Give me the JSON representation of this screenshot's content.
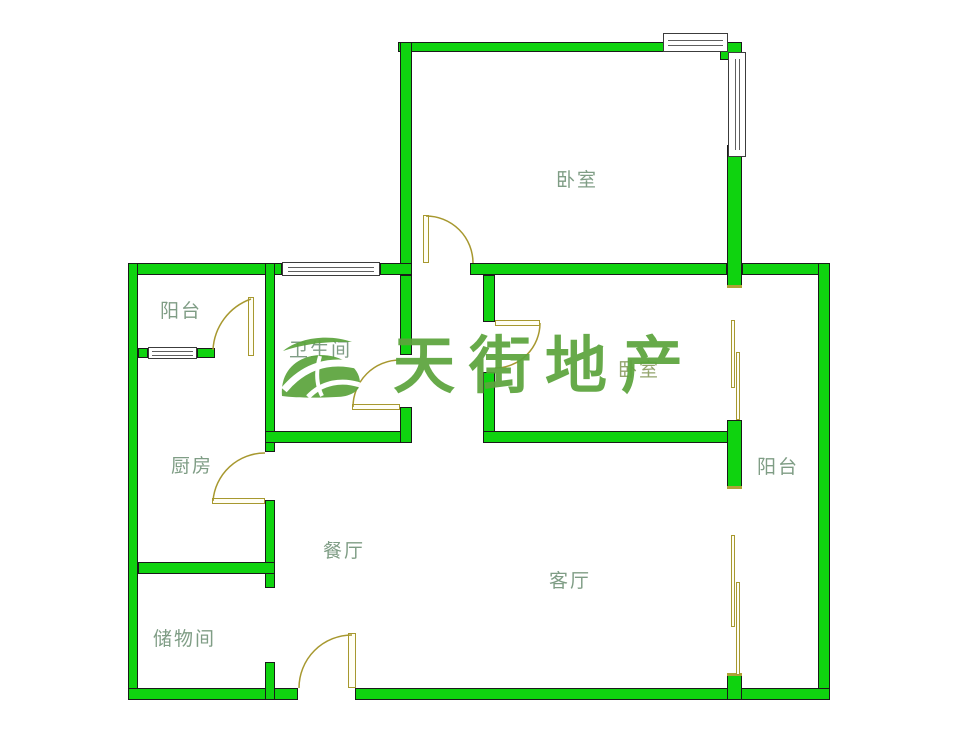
{
  "watermark": {
    "brand": "天街地产"
  },
  "rooms": {
    "bedroom_top": {
      "label": "卧室"
    },
    "balcony_top_left": {
      "label": "阳台"
    },
    "bathroom": {
      "label": "卫生间"
    },
    "bedroom_right": {
      "label": "卧室"
    },
    "balcony_right": {
      "label": "阳台"
    },
    "kitchen": {
      "label": "厨房"
    },
    "dining": {
      "label": "餐厅"
    },
    "living": {
      "label": "客厅"
    },
    "storage": {
      "label": "储物间"
    }
  },
  "colors": {
    "wall_fill": "#0fd30f",
    "wall_outline": "#1a1a1a",
    "door_line": "#a7982f",
    "room_label": "#7f9d85",
    "watermark_green": "#5ca43d",
    "background": "#ffffff"
  }
}
